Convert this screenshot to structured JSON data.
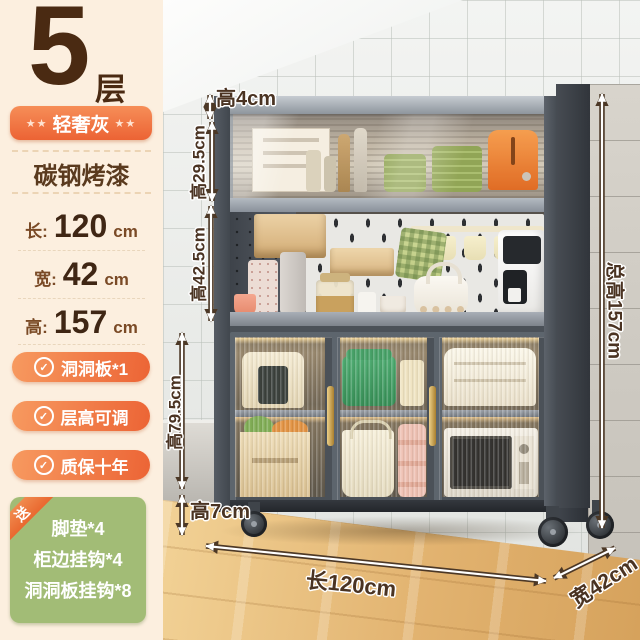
{
  "left_panel": {
    "tier_number": "5",
    "tier_unit": "层",
    "color_badge": {
      "stars_left": "★★",
      "name": "轻奢灰",
      "stars_right": "★★"
    },
    "material": "碳钢烤漆",
    "dimensions": [
      {
        "label": "长:",
        "value": "120",
        "unit": "cm"
      },
      {
        "label": "宽:",
        "value": "42",
        "unit": "cm"
      },
      {
        "label": "高:",
        "value": "157",
        "unit": "cm"
      }
    ],
    "check_glyph": "✓",
    "features": [
      {
        "text": "洞洞板*1"
      },
      {
        "text": "层高可调"
      },
      {
        "text": "质保十年"
      }
    ],
    "gift": {
      "ribbon": "送",
      "items": [
        "脚垫*4",
        "柜边挂钩*4",
        "洞洞板挂钩*8"
      ]
    }
  },
  "annotations": {
    "top_frame_height": "高4cm",
    "upper_cabinet_height": "高29.5cm",
    "middle_section_height": "高42.5cm",
    "lower_cabinet_height": "高79.5cm",
    "caster_height": "高7cm",
    "total_height": "总高157cm",
    "length": "长120cm",
    "depth": "宽42cm"
  },
  "colors": {
    "accent_orange": "#ee6f3d",
    "panel_cream": "#fcefdf",
    "gift_green": "#a2bc76",
    "text_brown": "#4a3322",
    "cabinet_gray": "#4b5158"
  }
}
